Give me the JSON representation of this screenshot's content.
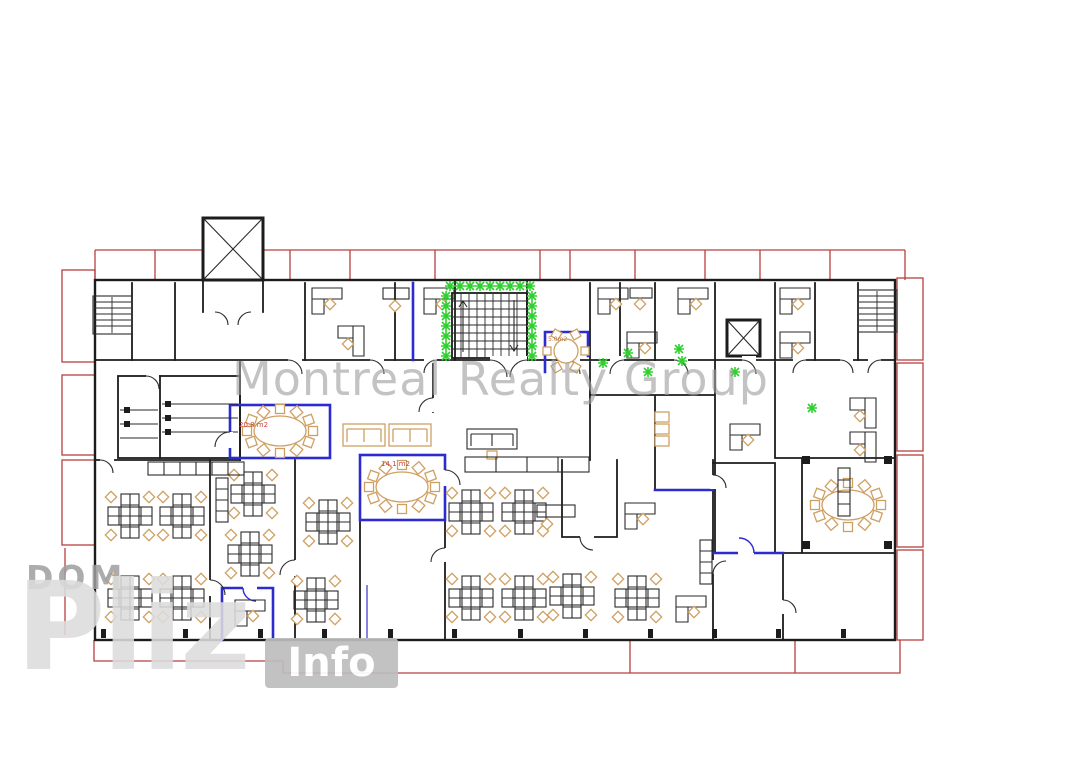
{
  "page": {
    "background": "#ffffff",
    "type": "architectural office floor plan"
  },
  "watermarks": {
    "center_text": "Montreal Realty Group",
    "logo": {
      "line1": "DOM",
      "line2": "Pliz",
      "badge": "Info"
    }
  },
  "plan": {
    "room_labels": [
      {
        "id": "conference_left",
        "label": "20.8 m2"
      },
      {
        "id": "conference_center",
        "label": "14.1 m2"
      },
      {
        "id": "meeting_small",
        "label": "5.0m2"
      }
    ],
    "symbols": [
      "elevator-icon",
      "staircase-icon",
      "plant-icon",
      "desk-cluster",
      "conference-table",
      "round-table",
      "sofa",
      "cabinet",
      "wc-stall",
      "door-arc"
    ],
    "colors": {
      "walls": "#1c1c1c",
      "partitions_blue": "#2b2bd0",
      "balcony_red": "#b64040",
      "furniture_tan": "#cfa063",
      "plants_green": "#2fd02f",
      "labels_red": "#cc4444",
      "watermark_gray": "#9f9f9f",
      "logo_gray": "#9e9e9e"
    }
  }
}
